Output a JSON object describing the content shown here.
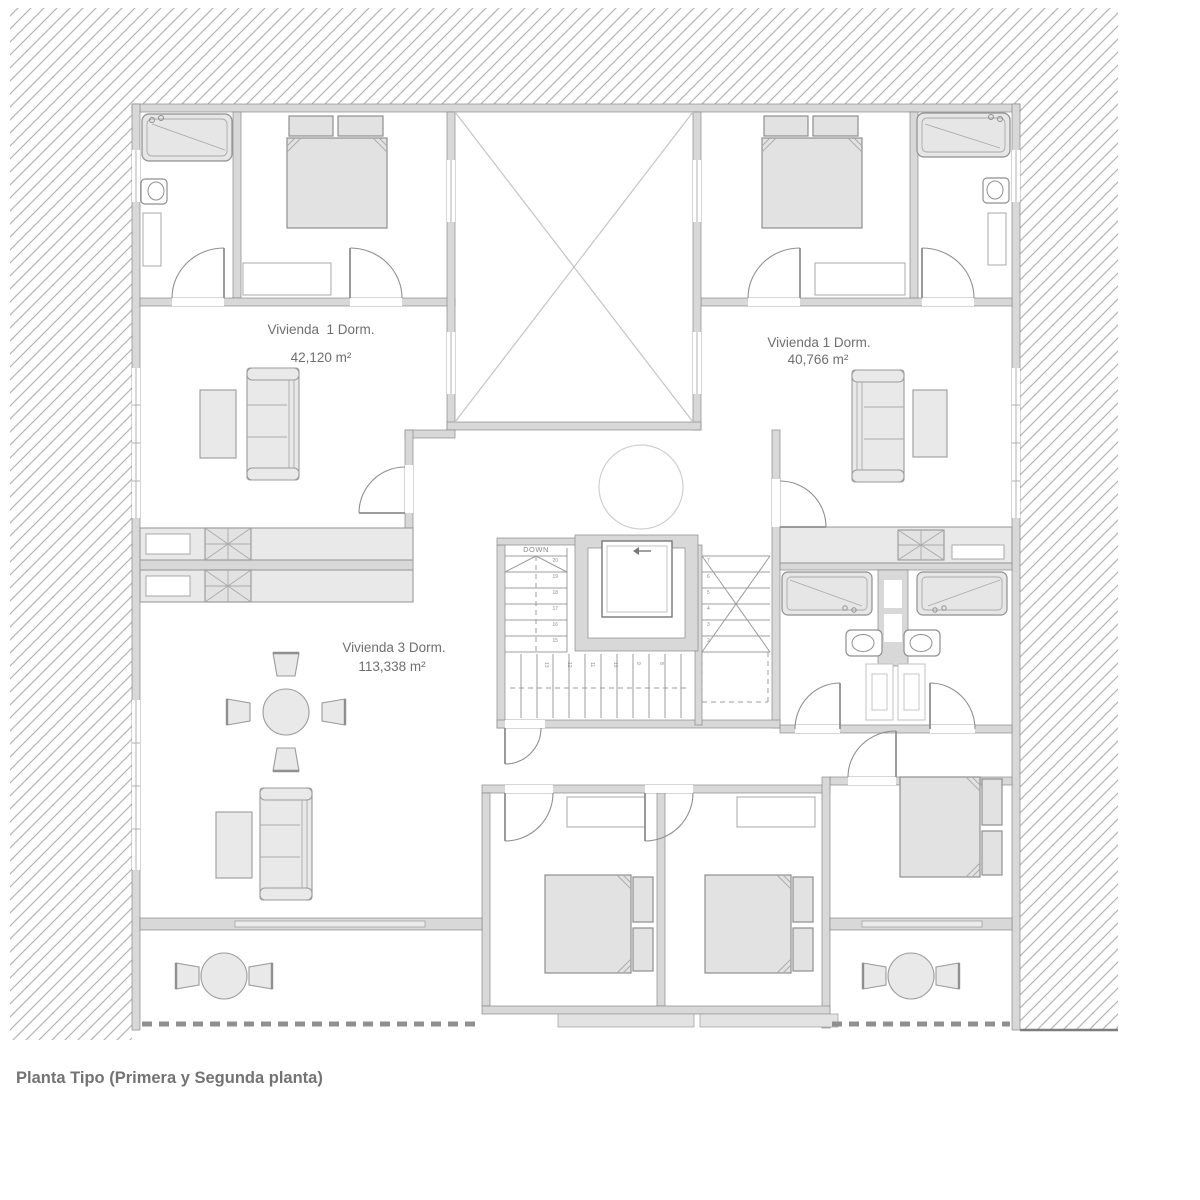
{
  "title": "Planta Tipo (Primera y Segunda planta)",
  "units": {
    "left": {
      "name": "Vivienda  1 Dorm.",
      "area": "42,120 m²"
    },
    "right": {
      "name": "Vivienda 1 Dorm.",
      "area": "40,766 m²"
    },
    "bottom": {
      "name": "Vivienda 3 Dorm.",
      "area": "113,338 m²"
    }
  },
  "stairs": {
    "down_label": "DOWN",
    "upper_flight_numbers": [
      "20",
      "19",
      "18",
      "17",
      "16",
      "15"
    ],
    "landing_numbers": [
      "13",
      "12",
      "11",
      "10",
      "9",
      "8"
    ],
    "lower_flight_numbers": [
      "7",
      "6",
      "5",
      "4",
      "3",
      "2"
    ]
  },
  "icons": {
    "elevator_direction": "arrow-left"
  },
  "colors": {
    "hatch_line": "#b5b5b5",
    "wall_fill": "#d8d8d8",
    "wall_stroke": "#8a8a8a",
    "furniture_fill": "#e9e9e9",
    "furniture_stroke": "#9b9b9b",
    "label_text": "#6f6f6f",
    "title_text": "#737373"
  }
}
